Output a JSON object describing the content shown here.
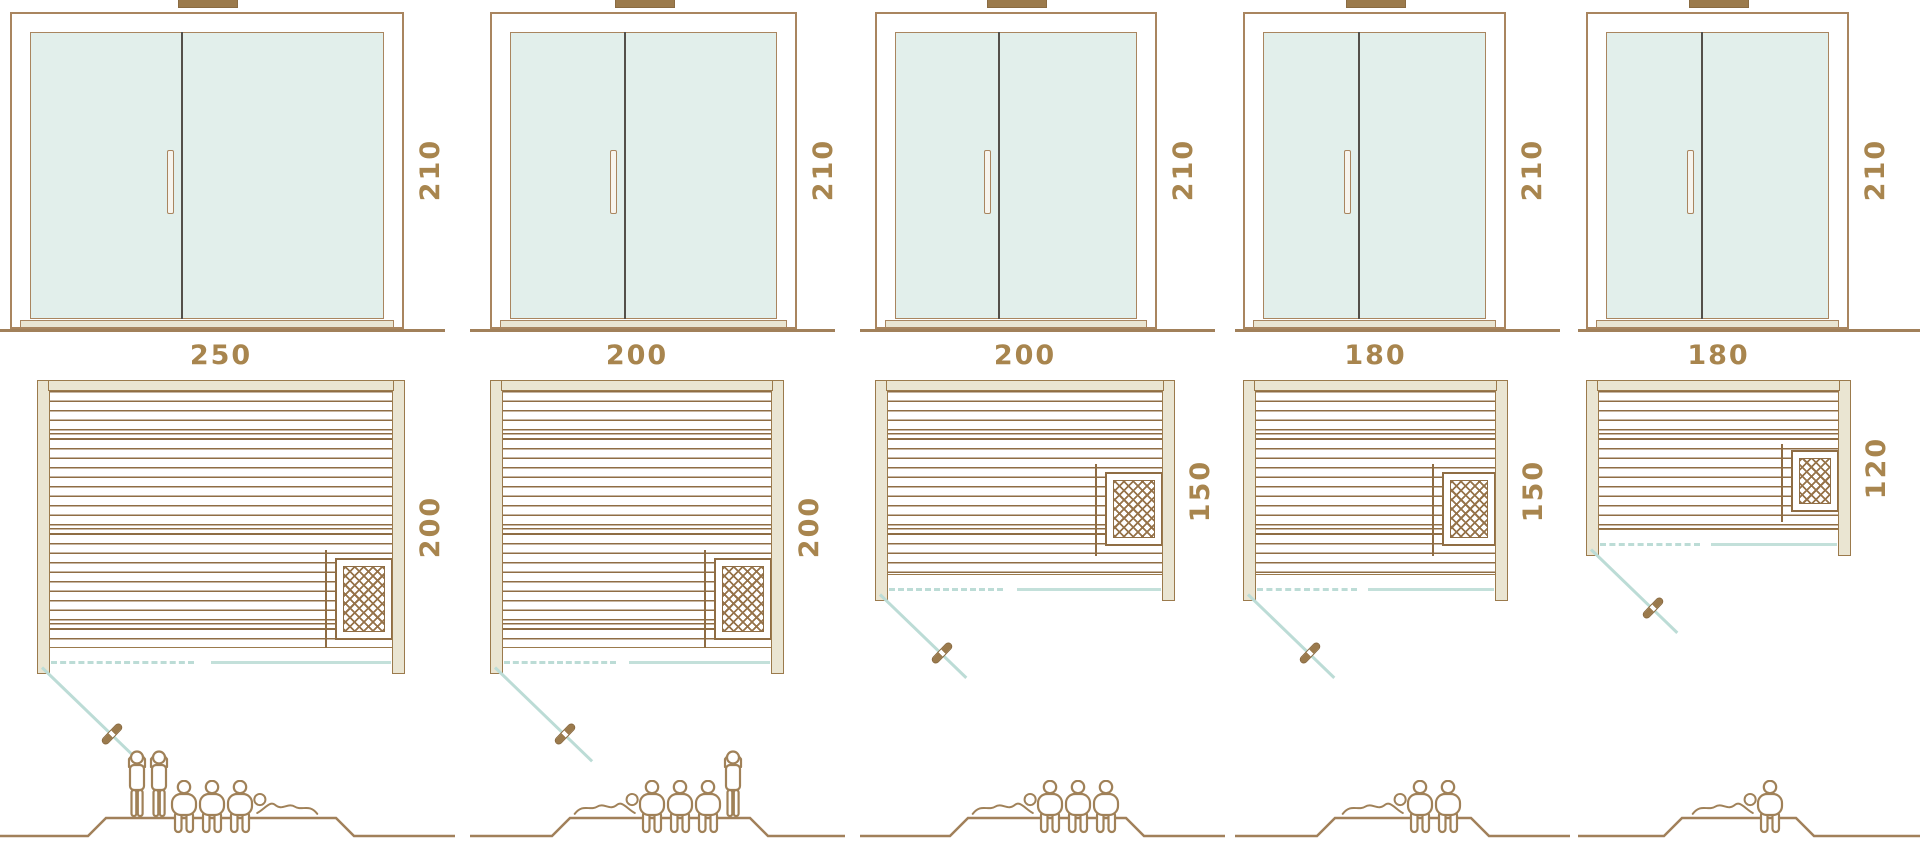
{
  "diagram_title": "sauna-size-comparison",
  "colors": {
    "frame_brown": "#a9855f",
    "plank_brown": "#8f6d44",
    "beige_fill": "#eae5d2",
    "glass_teal": "#e2efeb",
    "teal_line": "#bcdcd6",
    "dimension_text": "#a8854e",
    "ground_line": "#a1805a"
  },
  "models": [
    {
      "id": "sauna-250x200",
      "door_height": "210",
      "width": "250",
      "depth": "200",
      "figures": [
        "standing",
        "standing",
        "sitting",
        "sitting",
        "sitting",
        "lying-flipped"
      ]
    },
    {
      "id": "sauna-200x200",
      "door_height": "210",
      "width": "200",
      "depth": "200",
      "figures": [
        "lying",
        "sitting",
        "sitting",
        "sitting",
        "standing"
      ]
    },
    {
      "id": "sauna-200x150",
      "door_height": "210",
      "width": "200",
      "depth": "150",
      "figures": [
        "lying",
        "sitting",
        "sitting",
        "sitting"
      ]
    },
    {
      "id": "sauna-180x150",
      "door_height": "210",
      "width": "180",
      "depth": "150",
      "figures": [
        "lying",
        "sitting",
        "sitting"
      ]
    },
    {
      "id": "sauna-180x120",
      "door_height": "210",
      "width": "180",
      "depth": "120",
      "figures": [
        "lying",
        "sitting"
      ]
    }
  ]
}
